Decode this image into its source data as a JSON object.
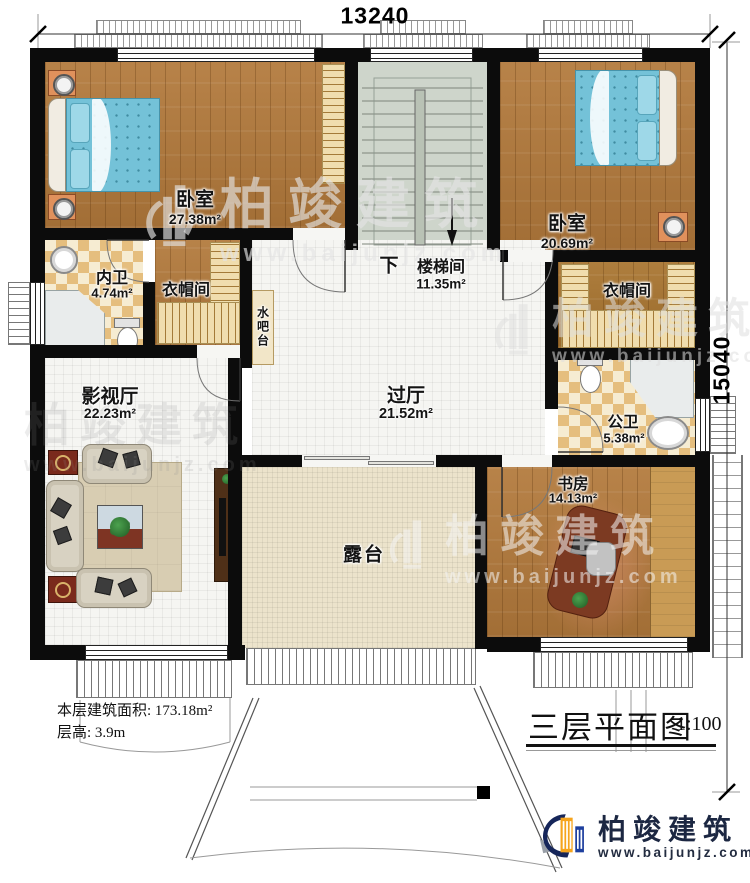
{
  "plan": {
    "dimension_top": "13240",
    "dimension_right": "15040",
    "rooms": {
      "bedroom_left": {
        "name": "卧室",
        "area": "27.38m²"
      },
      "bedroom_right": {
        "name": "卧室",
        "area": "20.69m²"
      },
      "stairwell": {
        "name": "楼梯间",
        "area": "11.35m²",
        "down_label": "下"
      },
      "ensuite_bath": {
        "name": "内卫",
        "area": "4.74m²"
      },
      "closet_left": {
        "name": "衣帽间"
      },
      "closet_right": {
        "name": "衣帽间"
      },
      "water_bar": {
        "name": "水吧台"
      },
      "hall": {
        "name": "过厅",
        "area": "21.52m²"
      },
      "public_bath": {
        "name": "公卫",
        "area": "5.38m²"
      },
      "media_room": {
        "name": "影视厅",
        "area": "22.23m²"
      },
      "study": {
        "name": "书房",
        "area": "14.13m²"
      },
      "terrace": {
        "name": "露台"
      }
    }
  },
  "info": {
    "floor_area": "本层建筑面积: 173.18m²",
    "floor_height": "层高: 3.9m"
  },
  "title_block": {
    "title": "三层平面图",
    "scale": "1:100"
  },
  "branding": {
    "company": "柏竣建筑",
    "website": "www.baijunjz.com"
  },
  "palette": {
    "wall": "#0c0c0c",
    "wood_floor": "#b2793b",
    "wood_dark": "#a8742f",
    "tile_white": "#f5f5f2",
    "checker_tan": "#e5be7e",
    "stair_gray": "#ced5cb",
    "terrace_tile": "#ece3cb",
    "bed_blue": "#74c2d8",
    "accent_red": "#7a2a1c",
    "cabinet_brown": "#4f3018",
    "logo_navy": "#16265a",
    "logo_orange": "#f6a41c",
    "logo_blue": "#1d3f9e"
  }
}
